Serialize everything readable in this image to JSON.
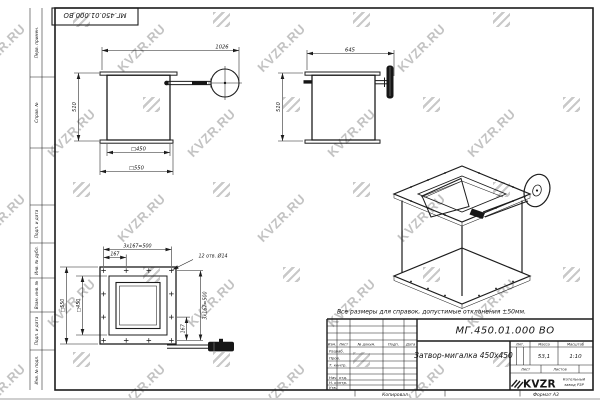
{
  "watermark": {
    "text": "KVZR.RU"
  },
  "stamp": {
    "doc_number": "МГ.450.01.000 ВО"
  },
  "margin": {
    "labels": [
      "Перв. примен.",
      "Справ. №",
      "Подп. и дата",
      "Инв. № дубл.",
      "Взам. инв. №",
      "Подп. и дата",
      "Инв. № подл."
    ]
  },
  "views": {
    "front": {
      "dim_width": "1026",
      "dim_height": "510",
      "dim_inner": "□450",
      "dim_outer": "□550"
    },
    "side": {
      "dim_width": "645",
      "dim_height": "510"
    },
    "plan": {
      "dim_pitch_top": "3x167=500",
      "dim_offset_top": "167",
      "dim_holes": "12 отв. Ø14",
      "dim_inner": "□450",
      "dim_outer": "□550",
      "dim_pitch_right": "3x167=500",
      "dim_offset_right": "167"
    }
  },
  "note": {
    "text": "Все размеры для справок, допустимые отклонения ±50мм."
  },
  "title_block": {
    "doc_number": "МГ.450.01.000 ВО",
    "title": "Затвор-мигалка 450x450",
    "col_izm": "Изм.",
    "col_list": "Лист",
    "col_doc": "№ докум.",
    "col_podp": "Подп.",
    "col_data": "Дата",
    "row_razrab": "Разраб.",
    "row_prov": "Пров.",
    "row_tkontr": "Т. контр.",
    "row_nachotd": "Нач. отд.",
    "row_nkontr": "Н. контр.",
    "row_utv": "Утв.",
    "lit_label": "Лит.",
    "mass_label": "Масса",
    "scale_label": "Масштаб",
    "mass_value": "53,1",
    "scale_value": "1:10",
    "sheet_label": "Лист",
    "sheets_label": "Листов",
    "logo_text": "KVZR",
    "company_line1": "Котельный",
    "company_line2": "завод РЗР"
  },
  "footer": {
    "copied": "Копировал",
    "format": "Формат А3"
  }
}
